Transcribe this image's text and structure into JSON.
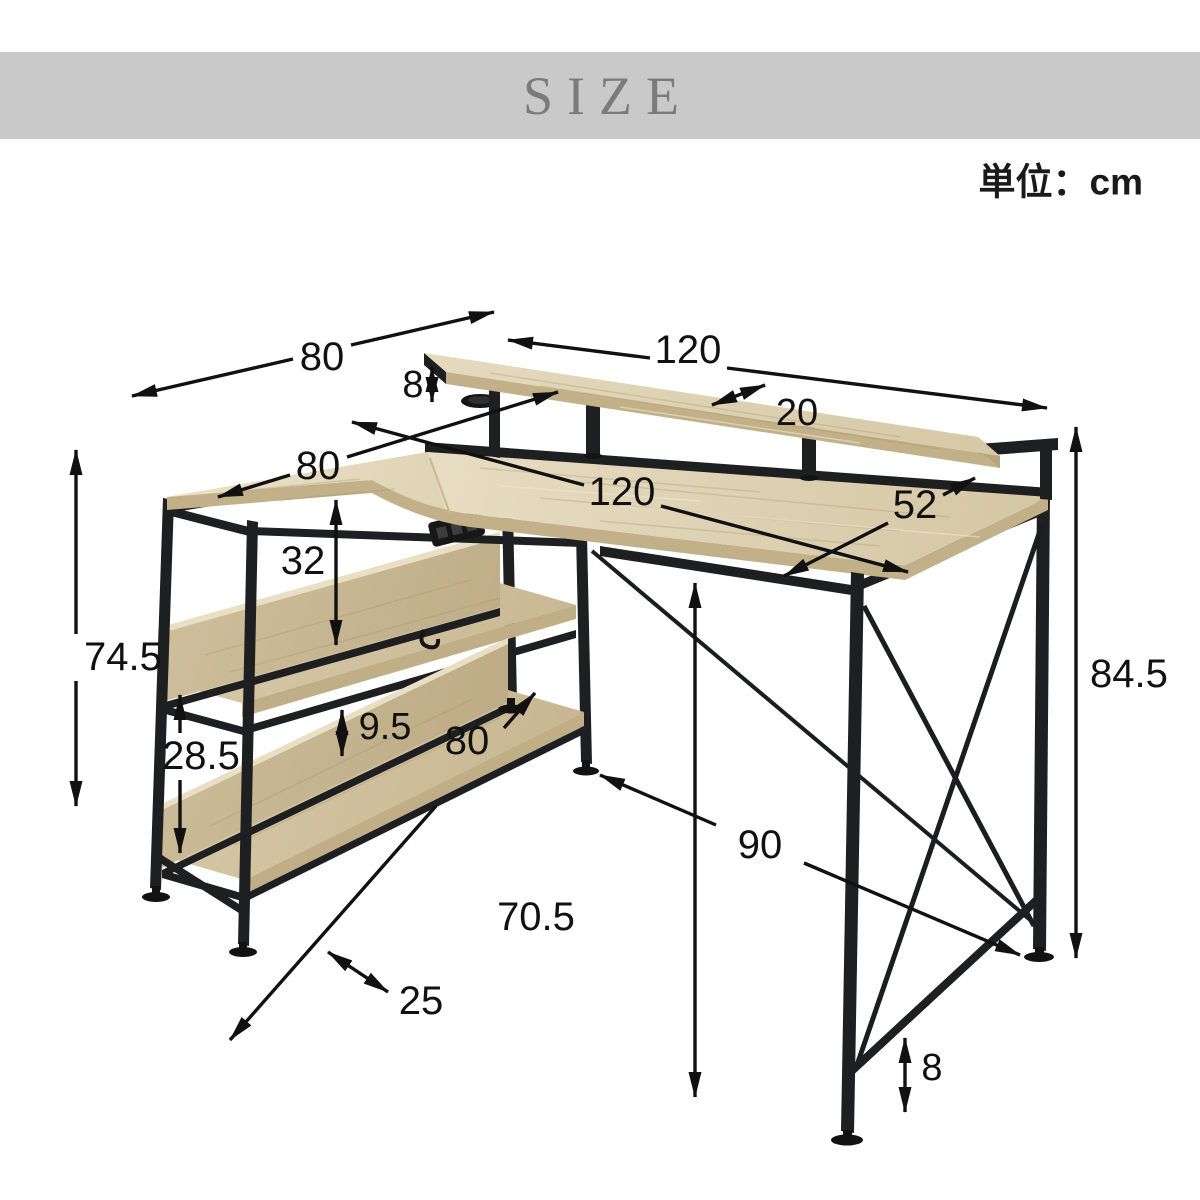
{
  "header": {
    "title": "SIZE",
    "unit_label": "単位：cm"
  },
  "dimensions": {
    "left_depth": "80",
    "top_shelf_width": "120",
    "monitor_riser_height": "8",
    "top_shelf_depth": "20",
    "wing_depth": "80",
    "desktop_width": "120",
    "desktop_depth": "52",
    "upper_shelf_gap": "32",
    "left_unit_height": "74.5",
    "lower_shelf_gap": "28.5",
    "back_panel_height": "9.5",
    "shelf_length": "80",
    "shelf_depth": "25",
    "floor_span": "90",
    "under_desk_clearance": "70.5",
    "total_height": "84.5",
    "base_bar_height": "8"
  },
  "colors": {
    "banner_bg": "#c9c9c9",
    "banner_text": "#7b7b7b",
    "wood_light": "#e6dcc1",
    "wood_mid": "#d5c7a3",
    "wood_edge": "#c2b089",
    "metal_black": "#1e1f21",
    "dimension_ink": "#111111"
  }
}
